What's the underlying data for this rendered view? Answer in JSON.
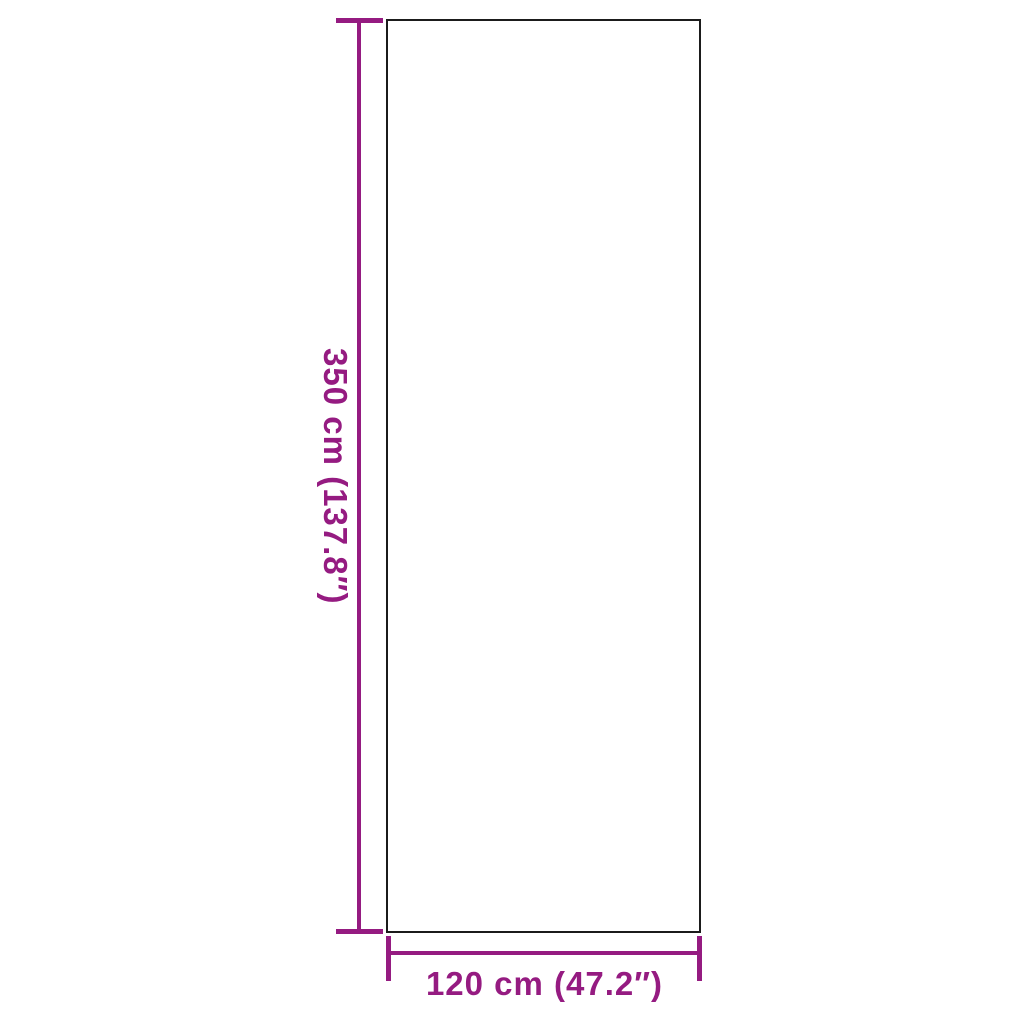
{
  "diagram": {
    "kind": "product-dimension-diagram",
    "dimensions": {
      "height": {
        "cm": 350,
        "inches": 137.8,
        "label": "350 cm (137.8″)"
      },
      "width": {
        "cm": 120,
        "inches": 47.2,
        "label": "120 cm (47.2″)"
      }
    },
    "colors": {
      "accent": "#951B81",
      "outline": "#1b1b1b",
      "background": "#ffffff"
    }
  }
}
